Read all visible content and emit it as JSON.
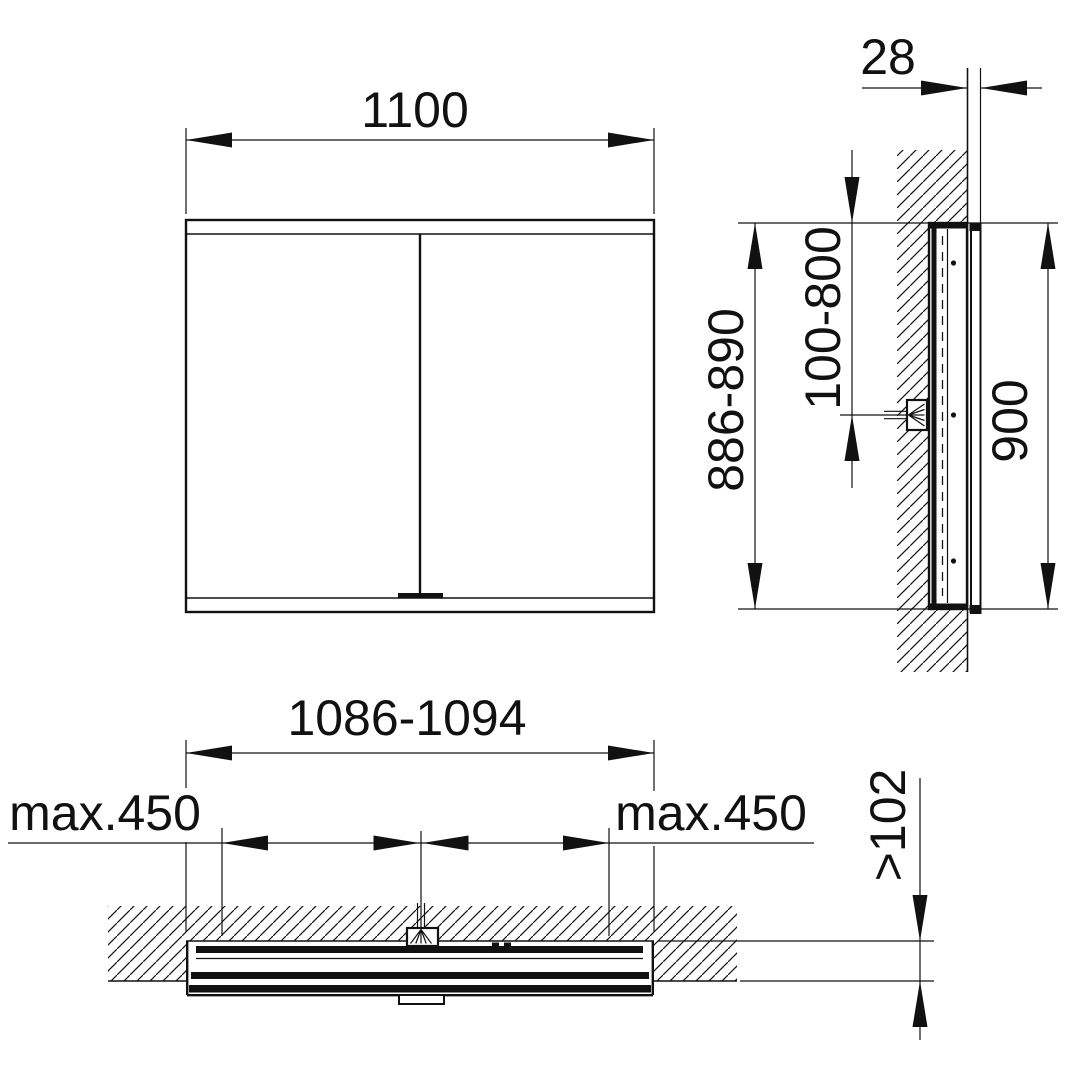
{
  "colors": {
    "line": "#111111",
    "background": "#ffffff"
  },
  "views": {
    "front": {
      "width": "1100"
    },
    "side": {
      "wall_clearance": "28",
      "recess_height": "886-890",
      "cable_exit_zone": "100-800",
      "height": "900"
    },
    "plan": {
      "recess_width": "1086-1094",
      "fixing_left": "max.450",
      "fixing_right": "max.450",
      "recess_depth": ">102"
    }
  }
}
